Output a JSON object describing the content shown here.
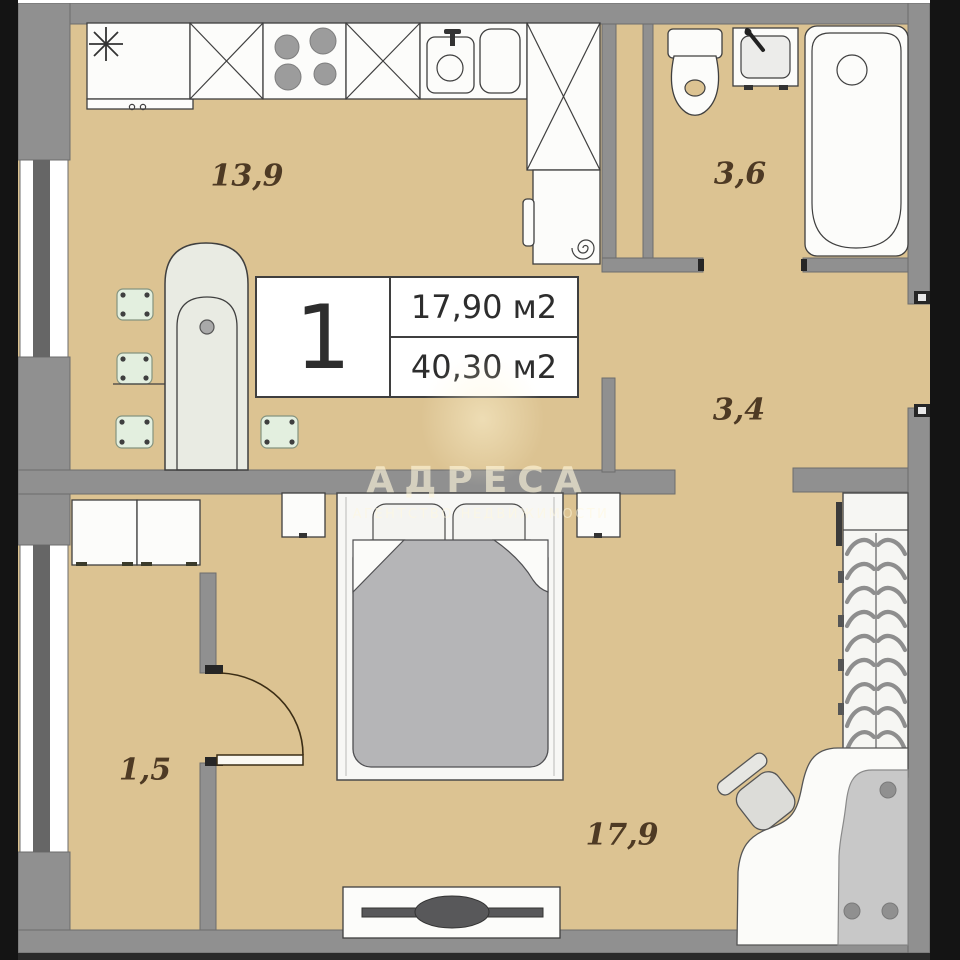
{
  "plan": {
    "info_box": {
      "number": "1",
      "room_area": "17,90 м2",
      "total_area": "40,30 м2"
    },
    "rooms": {
      "kitchen": {
        "label": "13,9"
      },
      "bathroom": {
        "label": "3,6"
      },
      "hallway": {
        "label": "3,4"
      },
      "balcony": {
        "label": "1,5"
      },
      "living_room": {
        "label": "17,9"
      }
    },
    "watermark": {
      "title": "АДРЕСА",
      "subtitle": "АГЕНТСТВО НЕДВИЖИМОСТИ"
    },
    "colors": {
      "floor": "#dcc392",
      "wall": "#909090",
      "wall_edge": "#6d6d6d",
      "window_bar": "#666666",
      "furniture": "#fcfcfa",
      "duvet": "#b5b5b7",
      "stool": "#e3efdf",
      "label_text": "#4e3a24",
      "black_bar": "#141414",
      "watermark_text": "#fff7dc"
    }
  }
}
